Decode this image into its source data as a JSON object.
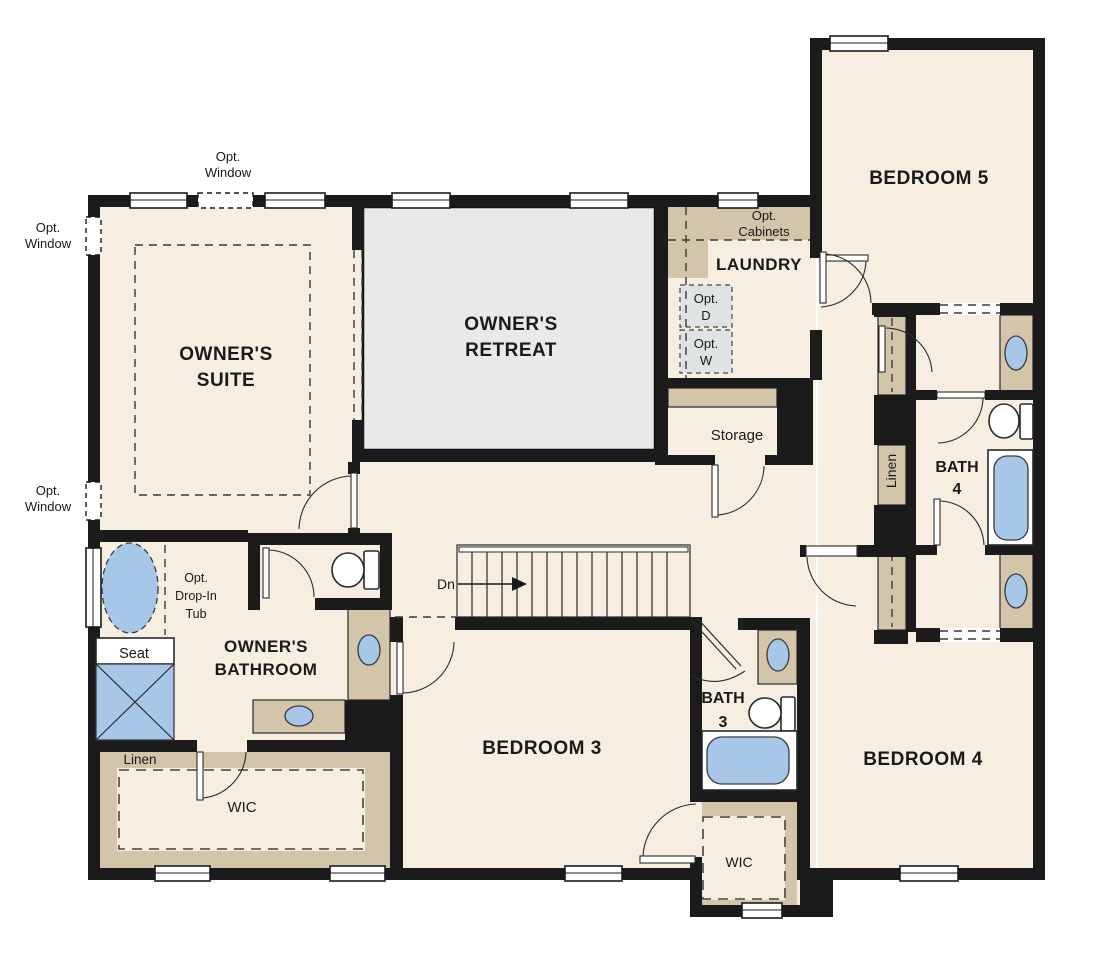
{
  "plan_type": "floor-plan",
  "rooms": {
    "owners_suite": [
      "OWNER'S",
      "SUITE"
    ],
    "owners_retreat": [
      "OWNER'S",
      "RETREAT"
    ],
    "owners_bathroom": [
      "OWNER'S",
      "BATHROOM"
    ],
    "bedroom5": "BEDROOM 5",
    "bedroom4": "BEDROOM 4",
    "bedroom3": "BEDROOM 3",
    "laundry": "LAUNDRY",
    "bath4": [
      "BATH",
      "4"
    ],
    "bath3": [
      "BATH",
      "3"
    ],
    "storage": "Storage",
    "wic_owner": "WIC",
    "wic_bedroom4": "WIC",
    "linen_hall": "Linen",
    "linen_owner": "Linen"
  },
  "annotations": {
    "opt_window": [
      "Opt.",
      "Window"
    ],
    "opt_cabinets": [
      "Opt.",
      "Cabinets"
    ],
    "opt_dryer": [
      "Opt.",
      "D"
    ],
    "opt_washer": [
      "Opt.",
      "W"
    ],
    "opt_drop_in_tub": [
      "Opt.",
      "Drop-In",
      "Tub"
    ],
    "seat": "Seat",
    "stairs_down": "Dn"
  },
  "colors": {
    "wall": "#1b1b1b",
    "floor": "#f6eee1",
    "owners_retreat_floor": "#e9e9e9",
    "cabinet_counter": "#d2c5aa",
    "plumbing_fixture": "#a6c7e7",
    "optional_appliance": "#dfe3e4",
    "background": "#ffffff"
  }
}
